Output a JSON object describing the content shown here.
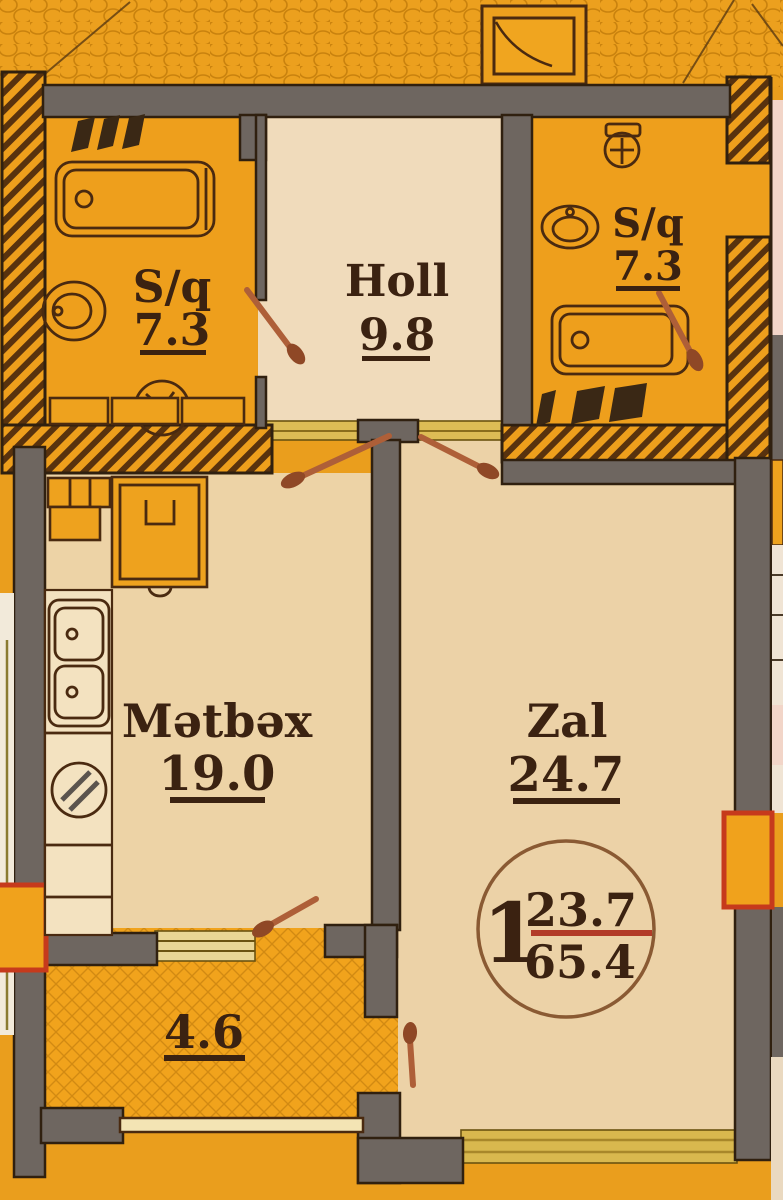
{
  "plan": {
    "rooms": [
      {
        "id": "bath-left",
        "label": "S/q",
        "area": "7.3"
      },
      {
        "id": "hall",
        "label": "Holl",
        "area": "9.8"
      },
      {
        "id": "bath-right",
        "label": "S/q",
        "area": "7.3"
      },
      {
        "id": "kitchen",
        "label": "Mətbəx",
        "area": "19.0"
      },
      {
        "id": "living",
        "label": "Zal",
        "area": "24.7"
      },
      {
        "id": "balcony",
        "label": "",
        "area": "4.6"
      }
    ],
    "unit": {
      "number": "1",
      "area_top": "23.7",
      "area_bottom": "65.4"
    },
    "colors": {
      "background": "#ea9e1d",
      "wall_gray": "#6e6660",
      "wall_outline": "#30200f",
      "floor_room": "#edd3a6",
      "floor_hall": "#f0dbbb",
      "floor_bath": "#ee9f1c",
      "floor_balcony": "#f1a31c",
      "threshold_yellow": "#d9b84e",
      "window_marker_red": "#c63a1c",
      "badge_red": "#b23b28",
      "badge_ring": "#8a5a33",
      "label_brown": "#3b2211",
      "door_swing": "#ae5f38"
    }
  }
}
